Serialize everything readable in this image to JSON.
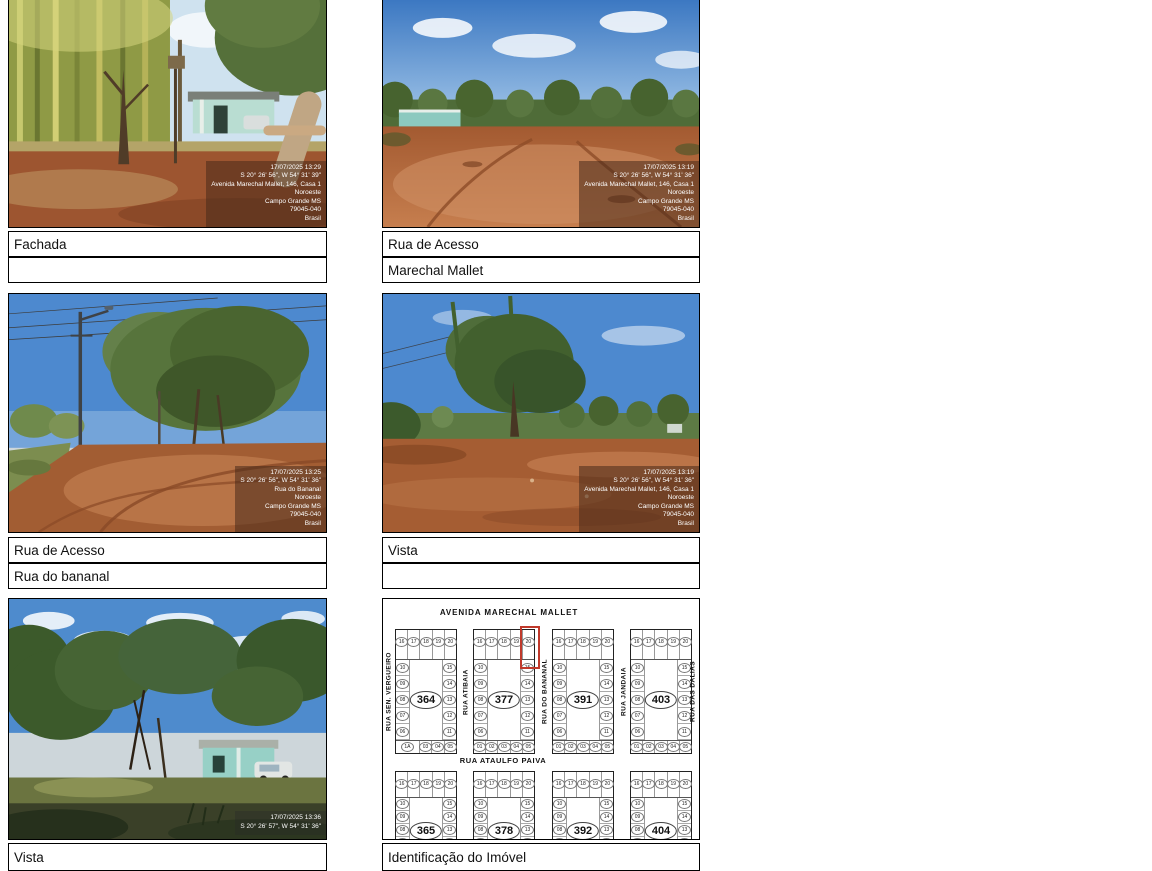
{
  "figures": [
    {
      "id": "fachada",
      "captions": [
        "Fachada",
        ""
      ],
      "watermark": [
        "17/07/2025 13:29",
        "S 20° 26' 56\", W 54° 31' 39\"",
        "Avenida Marechal Mallet, 146, Casa 1",
        "Noroeste",
        "Campo Grande MS",
        "79045-040",
        "Brasil"
      ]
    },
    {
      "id": "rua-de-acesso-marechal-mallet",
      "captions": [
        "Rua de Acesso",
        "Marechal Mallet"
      ],
      "watermark": [
        "17/07/2025 13:19",
        "S 20° 26' 56\", W 54° 31' 36\"",
        "Avenida Marechal Mallet, 146, Casa 1",
        "Noroeste",
        "Campo Grande MS",
        "79045-040",
        "Brasil"
      ]
    },
    {
      "id": "rua-de-acesso-rua-do-bananal",
      "captions": [
        "Rua de Acesso",
        "Rua do bananal"
      ],
      "watermark": [
        "17/07/2025 13:25",
        "S 20° 26' 56\", W 54° 31' 36\"",
        "Rua do Bananal",
        "Noroeste",
        "Campo Grande MS",
        "79045-040",
        "Brasil"
      ]
    },
    {
      "id": "vista-1",
      "captions": [
        "Vista",
        ""
      ],
      "watermark": [
        "17/07/2025 13:19",
        "S 20° 26' 56\", W 54° 31' 36\"",
        "Avenida Marechal Mallet, 146, Casa 1",
        "Noroeste",
        "Campo Grande MS",
        "79045-040",
        "Brasil"
      ]
    },
    {
      "id": "vista-2",
      "captions": [
        "Vista"
      ],
      "watermark": [
        "17/07/2025 13:36",
        "S 20° 26' 57\", W 54° 31' 36\""
      ]
    },
    {
      "id": "identificacao-do-imovel",
      "captions": [
        "Identificação do Imóvel"
      ]
    }
  ],
  "map": {
    "title_top": "AVENIDA MARECHAL MALLET",
    "street_middle": "RUA ATAULFO PAIVA",
    "vertical_streets": [
      "RUA SEN. VERGUEIRO",
      "RUA ATIBAIA",
      "RUA DO BANANAL",
      "RUA JANDAIA",
      "RUA DAS DALIAS"
    ],
    "blocks_top": [
      "364",
      "377",
      "391",
      "403"
    ],
    "blocks_bottom": [
      "365",
      "378",
      "392",
      "404"
    ],
    "lot_rows": {
      "top": [
        "16",
        "17",
        "18",
        "19",
        "20"
      ],
      "left": [
        "10",
        "09",
        "08",
        "07",
        "06"
      ],
      "right": [
        "15",
        "14",
        "13",
        "12",
        "11"
      ],
      "bottom": [
        "01",
        "02",
        "03",
        "04",
        "05"
      ]
    },
    "block_364_bottom": [
      "1A",
      "03",
      "04",
      "05"
    ],
    "highlight": {
      "block": "377",
      "lot": "20",
      "color": "#c0392b"
    }
  }
}
